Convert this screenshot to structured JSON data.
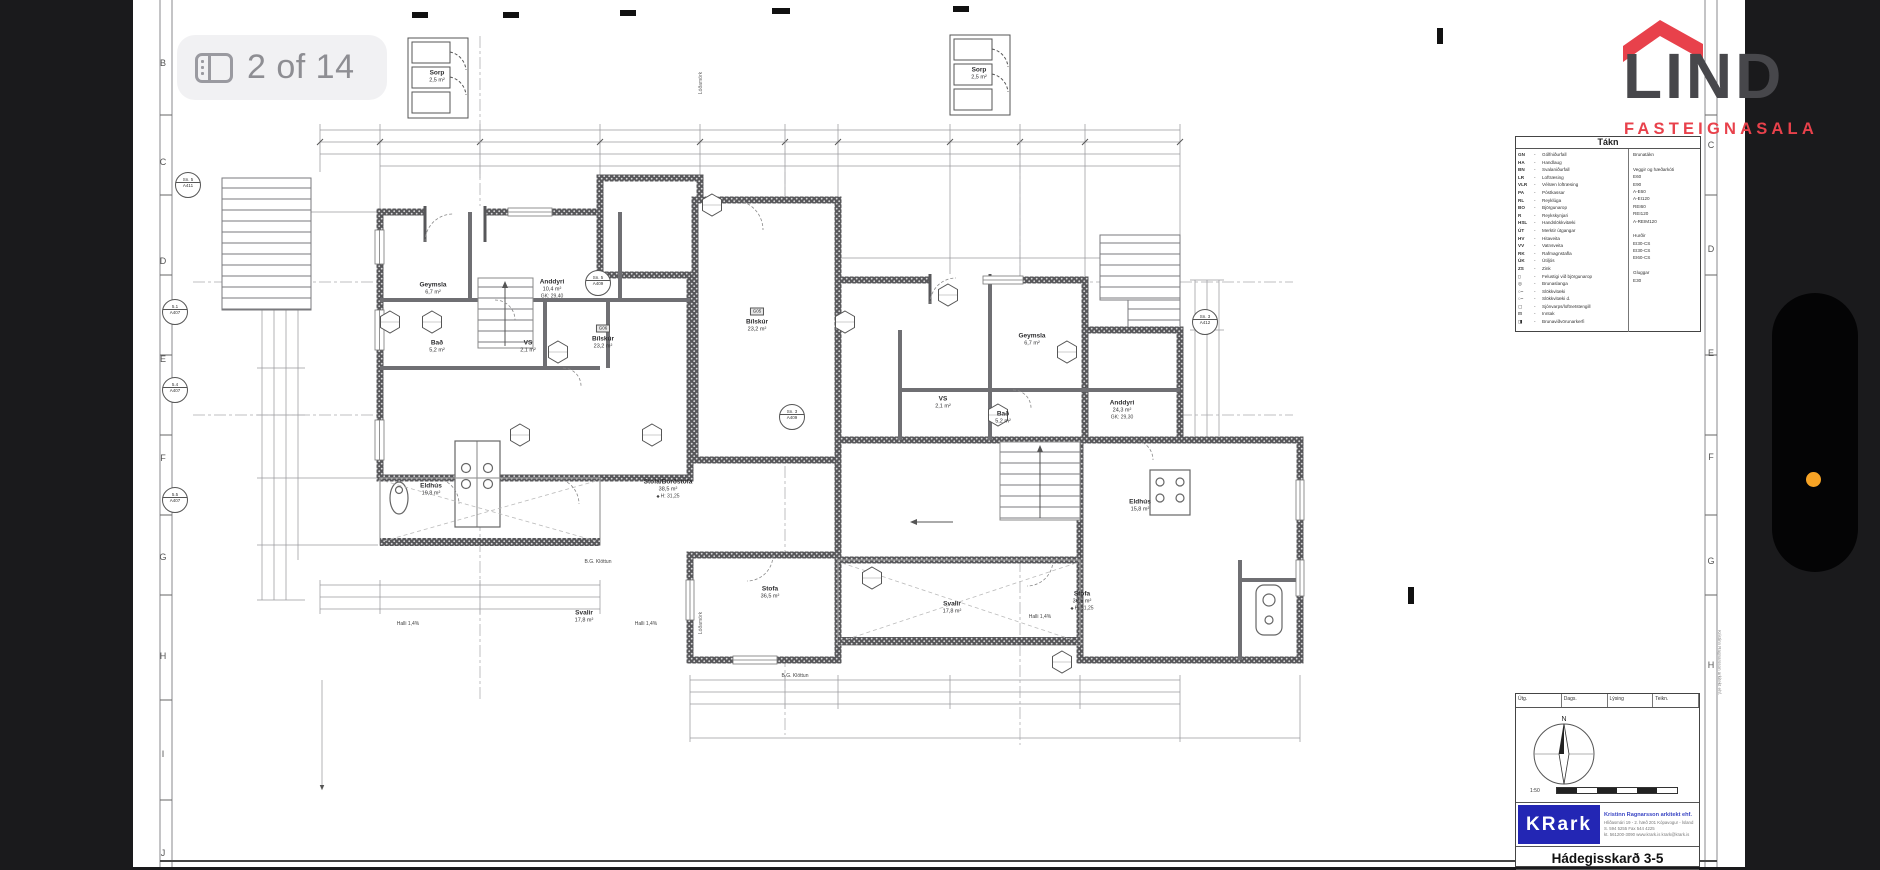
{
  "viewer": {
    "page_counter": "2 of 14"
  },
  "brand": {
    "name": "LIND",
    "tagline": "FASTEIGNASALA"
  },
  "colors": {
    "brand_red": "#E8414B",
    "brand_gray": "#47474B",
    "krark_blue": "#2326B4",
    "indicator_orange": "#F7A325"
  },
  "sheet": {
    "grid_left": [
      "B",
      "C",
      "D",
      "E",
      "F",
      "G",
      "H",
      "I",
      "J"
    ],
    "grid_right": [
      "C",
      "D",
      "E",
      "F",
      "G",
      "H"
    ],
    "legend": {
      "title": "Tákn",
      "items": [
        {
          "abbr": "GN",
          "label": "Gólfniðurfall"
        },
        {
          "abbr": "HA",
          "label": "Handlaug"
        },
        {
          "abbr": "BN",
          "label": "Svalaniðurfall"
        },
        {
          "abbr": "LR",
          "label": "Loftræsing"
        },
        {
          "abbr": "VLR",
          "label": "Vélræn loftræsing"
        },
        {
          "abbr": "PA",
          "label": "Póstkassar"
        },
        {
          "abbr": "RL",
          "label": "Reyklúga"
        },
        {
          "abbr": "BO",
          "label": "Björgunarop"
        },
        {
          "abbr": "R",
          "label": "Reykskynjari"
        },
        {
          "abbr": "HSL",
          "label": "Handslökkvitæki"
        },
        {
          "abbr": "ÚT",
          "label": "Merktir útgangar"
        },
        {
          "abbr": "HV",
          "label": "Hitaveita"
        },
        {
          "abbr": "VV",
          "label": "Vatnsveita"
        },
        {
          "abbr": "RK",
          "label": "Rafmagnstafla"
        },
        {
          "abbr": "ÚK",
          "label": "Útiljós"
        },
        {
          "abbr": "ZS",
          "label": "Zink"
        },
        {
          "abbr": "▯",
          "label": "Felustigi við björgunarop"
        },
        {
          "abbr": "◎",
          "label": "Brunaslanga"
        },
        {
          "abbr": "○–",
          "label": "Slökkvitæki"
        },
        {
          "abbr": "○–",
          "label": "Slökkvitæki d."
        },
        {
          "abbr": "▢",
          "label": "Sjónvarps/loftnetstengill"
        },
        {
          "abbr": "⊟",
          "label": "Inntak"
        },
        {
          "abbr": "◨",
          "label": "Brunaviðvörunarkerfi"
        }
      ],
      "right": [
        "Brunatákn",
        "",
        "Veggir og hæðarkóti",
        "E60",
        "E90",
        "A-E60",
        "A-EI120",
        "REI60",
        "REI120",
        "A-REIM120",
        "",
        "Hurðir",
        "EI30-CS",
        "EI30-CS",
        "EI60-CS",
        "",
        "Gluggar",
        "E30"
      ]
    },
    "title_block": {
      "columns": [
        "Útg.",
        "Dags.",
        "Lýsing",
        "Teikn."
      ],
      "firm": "KRark",
      "firm_full": "Kristinn Ragnarsson arkitekt ehf.",
      "address": "Hlíðasmári 19 - 2. hæð  201 Kópavogur - Ísland",
      "phone": "S. 594 5255   Fax 544 4225",
      "web": "kt. 561200-3090   www.krark.is   krark@krark.is",
      "project_title": "Hádegisskarð 3-5",
      "scale": "1:50",
      "north": "N"
    },
    "copyright_vertical": "Kristinn Ragnarsson arkitekt ehf.",
    "markers": [
      {
        "top": "Sn. 5",
        "bot": "A411"
      },
      {
        "top": "5.1",
        "bot": "A407"
      },
      {
        "top": "5.4",
        "bot": "A407"
      },
      {
        "top": "5.5",
        "bot": "A407"
      },
      {
        "top": "Sn. 5",
        "bot": "A409"
      },
      {
        "top": "Sn. 3",
        "bot": "A409"
      },
      {
        "top": "Sn. 3",
        "bot": "A412"
      }
    ],
    "notes": {
      "lot_line": "Lóðamörk"
    }
  },
  "plan": {
    "rooms": [
      {
        "name": "Sorp",
        "area": "2,5 m²"
      },
      {
        "name": "Sorp",
        "area": "2,5 m²"
      },
      {
        "name": "Geymsla",
        "area": "6,7 m²"
      },
      {
        "name": "Anddyri",
        "area": "10,4 m²",
        "extra": "GK: 29,40"
      },
      {
        "name": "Bað",
        "area": "5,2 m²"
      },
      {
        "name": "VS",
        "area": "2,1 m²"
      },
      {
        "name": "Bílskúr",
        "area": "23,2 m²",
        "extra": "G06"
      },
      {
        "name": "Bílskúr",
        "area": "23,2 m²",
        "extra": "G05"
      },
      {
        "name": "Eldhús",
        "area": "19,8 m²"
      },
      {
        "name": "Stofa/Borðstofa",
        "area": "38,5 m²",
        "extra": "H: 31,25"
      },
      {
        "name": "Svalir",
        "area": "17,8 m²"
      },
      {
        "name": "Halli 1,4%"
      },
      {
        "name": "Halli 1,4%"
      },
      {
        "name": "Anddyri",
        "area": "24,3 m²",
        "extra": "GK: 29,30"
      },
      {
        "name": "Geymsla",
        "area": "6,7 m²"
      },
      {
        "name": "VS",
        "area": "2,1 m²"
      },
      {
        "name": "Bað",
        "area": "5,2 m²"
      },
      {
        "name": "Eldhús",
        "area": "15,8 m²"
      },
      {
        "name": "Stofa",
        "area": "36,5 m²",
        "extra": "H: 31,25"
      },
      {
        "name": "Stofa",
        "area": "36,5 m²"
      },
      {
        "name": "Svalir",
        "area": "17,8 m²"
      },
      {
        "name": "Halli 1,4%"
      },
      {
        "name": "B.G. Klöttun"
      },
      {
        "name": "B.G. Klöttun"
      }
    ]
  }
}
